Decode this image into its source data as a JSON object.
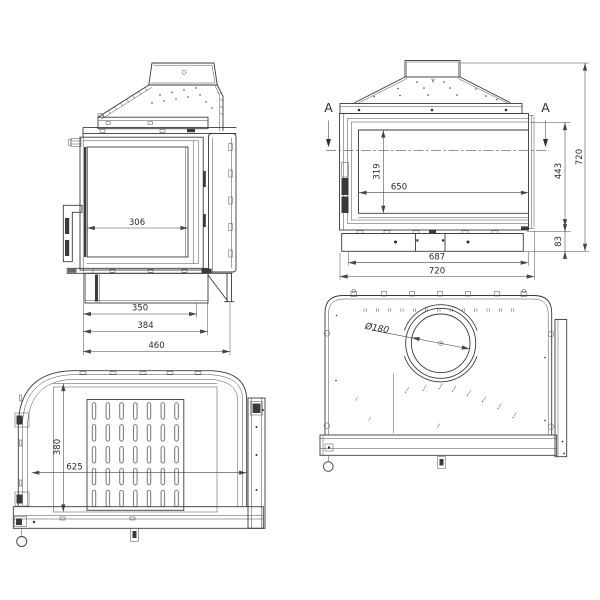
{
  "drawing": {
    "colors": {
      "background": "#ffffff",
      "line": "#3a3a3a",
      "dim_text": "#2b2b2b"
    },
    "views": {
      "side": {
        "dims": {
          "glass_width": "306",
          "base_depth": "350",
          "body_depth": "384",
          "total_depth": "460"
        }
      },
      "front": {
        "section_marker": "A",
        "dims": {
          "glass_height": "319",
          "glass_width": "650",
          "firebox_height": "443",
          "total_height": "720",
          "plinth_height": "83",
          "body_width": "687",
          "total_width": "720"
        }
      },
      "plan": {
        "dims": {
          "inner_depth": "380",
          "inner_width": "625"
        }
      },
      "rear": {
        "dims": {
          "flue_diameter": "Ø180"
        }
      }
    }
  }
}
